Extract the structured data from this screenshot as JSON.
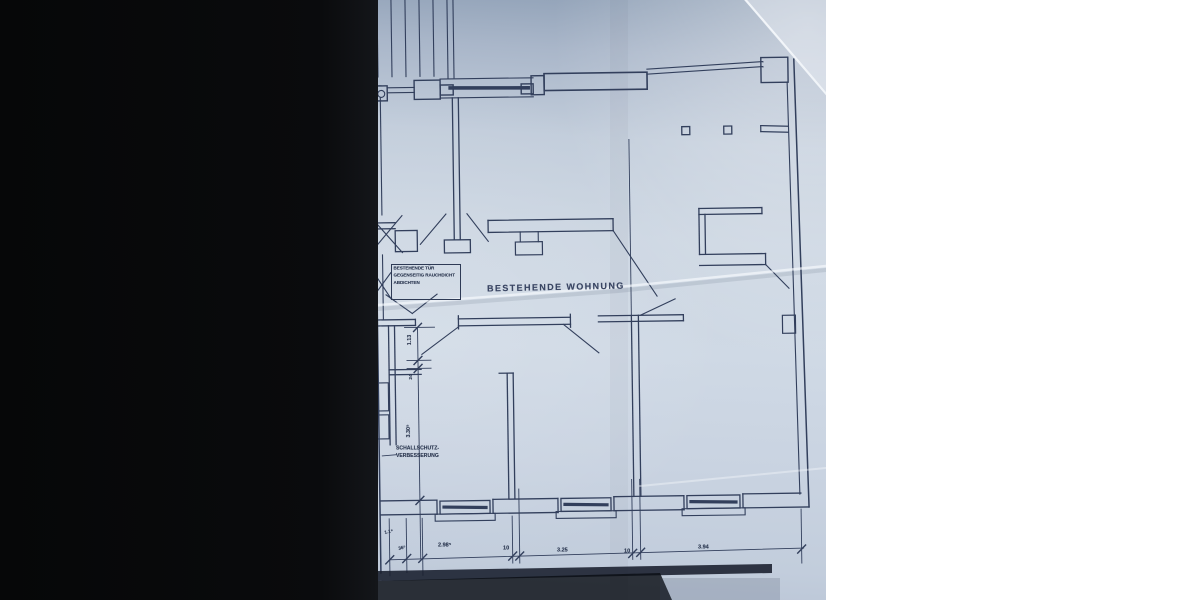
{
  "plan": {
    "room_label": "BESTEHENDE WOHNUNG",
    "note_box": {
      "line1": "BESTEHENDE TÜR",
      "line2": "GEGENSEITIG RAUCHDICHT",
      "line3": "ABDICHTEN"
    },
    "sound_note": {
      "line1": "SCHALLSCHUTZ-",
      "line2": "VERBESSERUNG"
    },
    "dimensions_bottom": {
      "d1": "1.1⁸",
      "d2": "36⁵",
      "d3": "2.98⁵",
      "d4": "10",
      "d5": "3.25",
      "d6": "10",
      "d7": "3.94"
    },
    "dimensions_left": {
      "d1": "1.13",
      "d2": "24",
      "d3": "3.30⁵"
    },
    "colors": {
      "ink": "#2e3a55",
      "paper": "#c9d3e0",
      "photo_margin": "#0a0b0d"
    }
  }
}
